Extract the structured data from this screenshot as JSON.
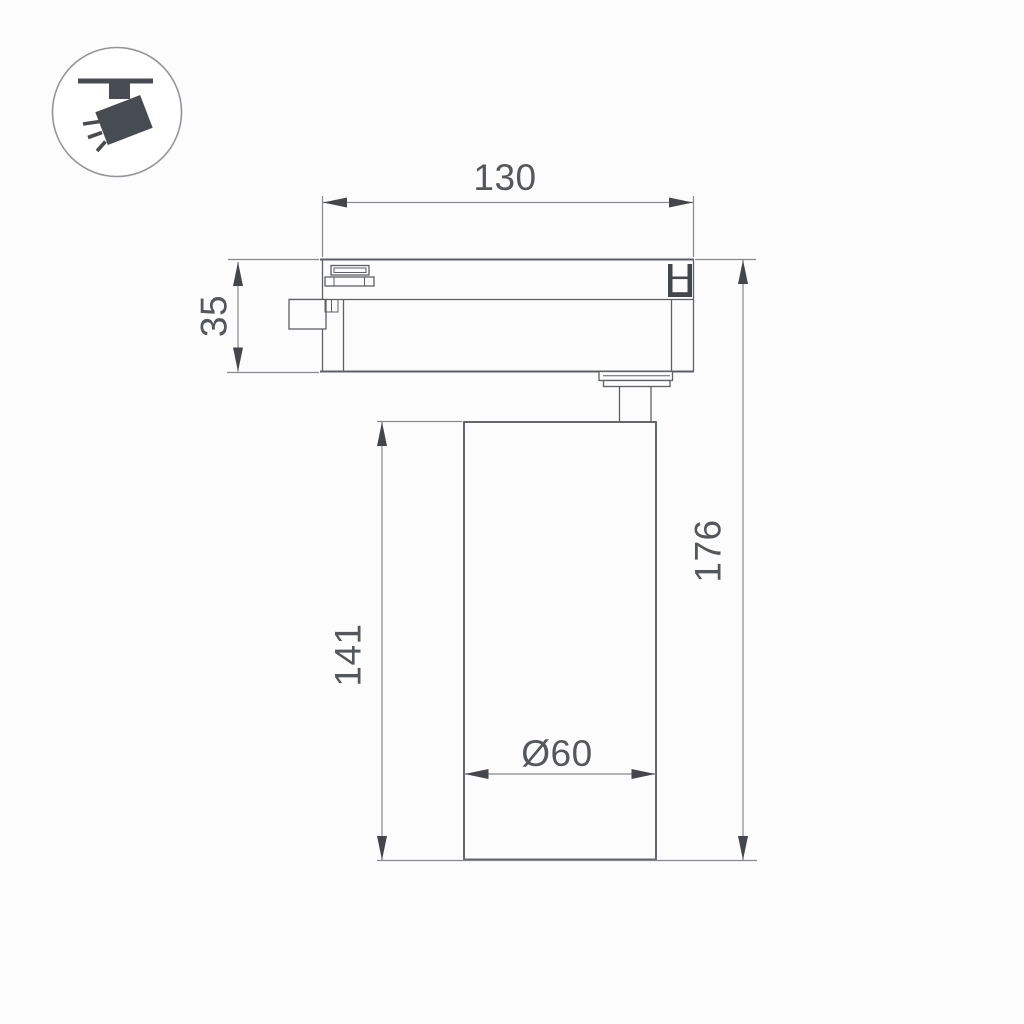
{
  "icon": {
    "name": "ceiling-track-spotlight-pictogram"
  },
  "dimensions": {
    "track_width": {
      "value": "130"
    },
    "adapter_height": {
      "value": "35"
    },
    "body_height": {
      "value": "141"
    },
    "total_height": {
      "value": "176"
    },
    "body_diameter": {
      "value": "Ø60"
    }
  },
  "colors": {
    "background": "#fcfcfc",
    "outline": "#5d6166",
    "thin_line": "#87898c",
    "dimension_text": "#54575b",
    "arrow": "#43464a",
    "icon_fill": "#474c52",
    "icon_circle_stroke": "#939598"
  }
}
